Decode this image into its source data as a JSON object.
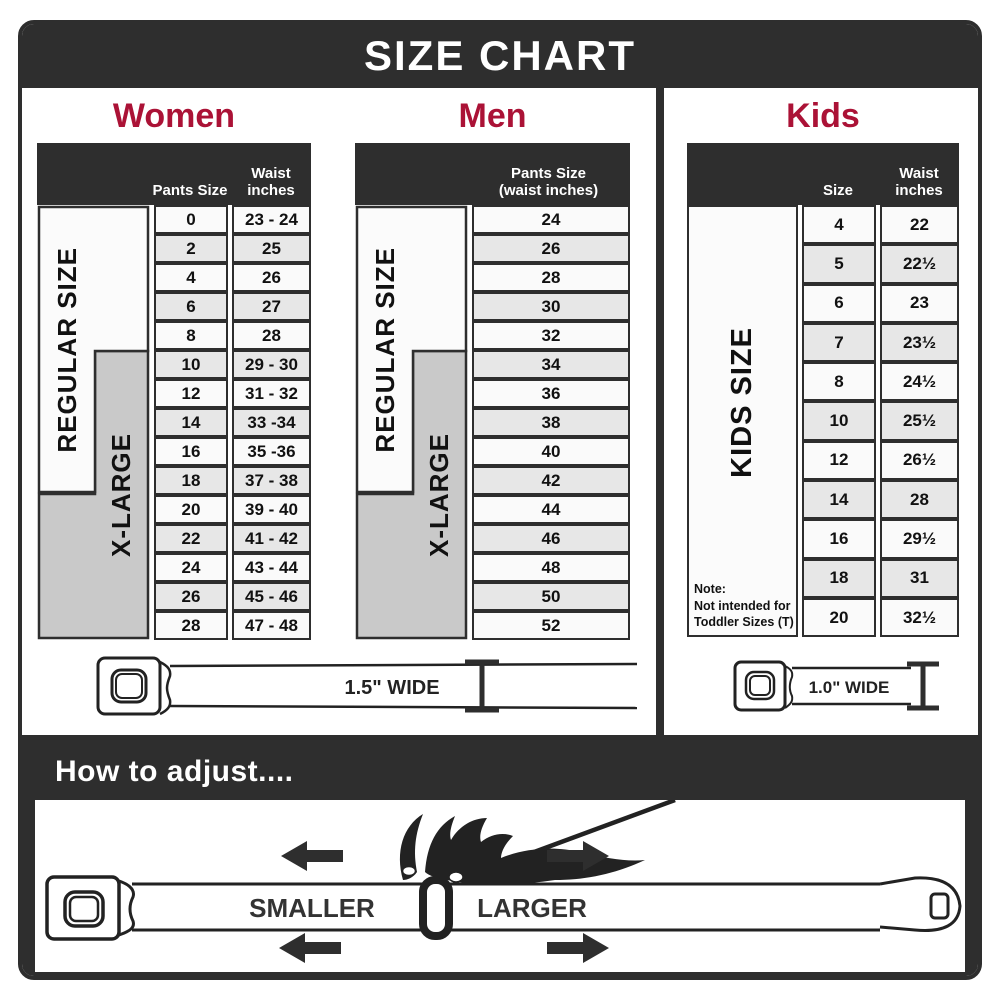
{
  "title": "SIZE CHART",
  "colors": {
    "accent": "#ab1236",
    "dark": "#2e2e2e",
    "row_light": "#fafafa",
    "row_shade": "#e7e7e7",
    "label_gray": "#c9c9c9"
  },
  "women": {
    "heading": "Women",
    "col_size": "Pants Size",
    "col_waist": "Waist inches",
    "regular_label": "REGULAR SIZE",
    "xlarge_label": "X-LARGE",
    "rows": [
      {
        "size": "0",
        "waist": "23 - 24"
      },
      {
        "size": "2",
        "waist": "25"
      },
      {
        "size": "4",
        "waist": "26"
      },
      {
        "size": "6",
        "waist": "27"
      },
      {
        "size": "8",
        "waist": "28"
      },
      {
        "size": "10",
        "waist": "29 - 30"
      },
      {
        "size": "12",
        "waist": "31 - 32"
      },
      {
        "size": "14",
        "waist": "33 -34"
      },
      {
        "size": "16",
        "waist": "35 -36"
      },
      {
        "size": "18",
        "waist": "37 - 38"
      },
      {
        "size": "20",
        "waist": "39 - 40"
      },
      {
        "size": "22",
        "waist": "41 - 42"
      },
      {
        "size": "24",
        "waist": "43 - 44"
      },
      {
        "size": "26",
        "waist": "45 - 46"
      },
      {
        "size": "28",
        "waist": "47 - 48"
      }
    ]
  },
  "men": {
    "heading": "Men",
    "col_line1": "Pants Size",
    "col_line2": "(waist inches)",
    "regular_label": "REGULAR SIZE",
    "xlarge_label": "X-LARGE",
    "rows": [
      "24",
      "26",
      "28",
      "30",
      "32",
      "34",
      "36",
      "38",
      "40",
      "42",
      "44",
      "46",
      "48",
      "50",
      "52"
    ]
  },
  "kids": {
    "heading": "Kids",
    "col_size": "Size",
    "col_waist": "Waist inches",
    "side_label": "KIDS SIZE",
    "note": {
      "line1": "Note:",
      "line2": "Not intended for",
      "line3": "Toddler Sizes (T)"
    },
    "rows": [
      {
        "size": "4",
        "waist": "22"
      },
      {
        "size": "5",
        "waist": "22½"
      },
      {
        "size": "6",
        "waist": "23"
      },
      {
        "size": "7",
        "waist": "23½"
      },
      {
        "size": "8",
        "waist": "24½"
      },
      {
        "size": "10",
        "waist": "25½"
      },
      {
        "size": "12",
        "waist": "26½"
      },
      {
        "size": "14",
        "waist": "28"
      },
      {
        "size": "16",
        "waist": "29½"
      },
      {
        "size": "18",
        "waist": "31"
      },
      {
        "size": "20",
        "waist": "32½"
      }
    ]
  },
  "belts": {
    "adult_width_label": "1.5\" WIDE",
    "kids_width_label": "1.0\" WIDE"
  },
  "adjust": {
    "title": "How to adjust....",
    "smaller_label": "SMALLER",
    "larger_label": "LARGER"
  }
}
